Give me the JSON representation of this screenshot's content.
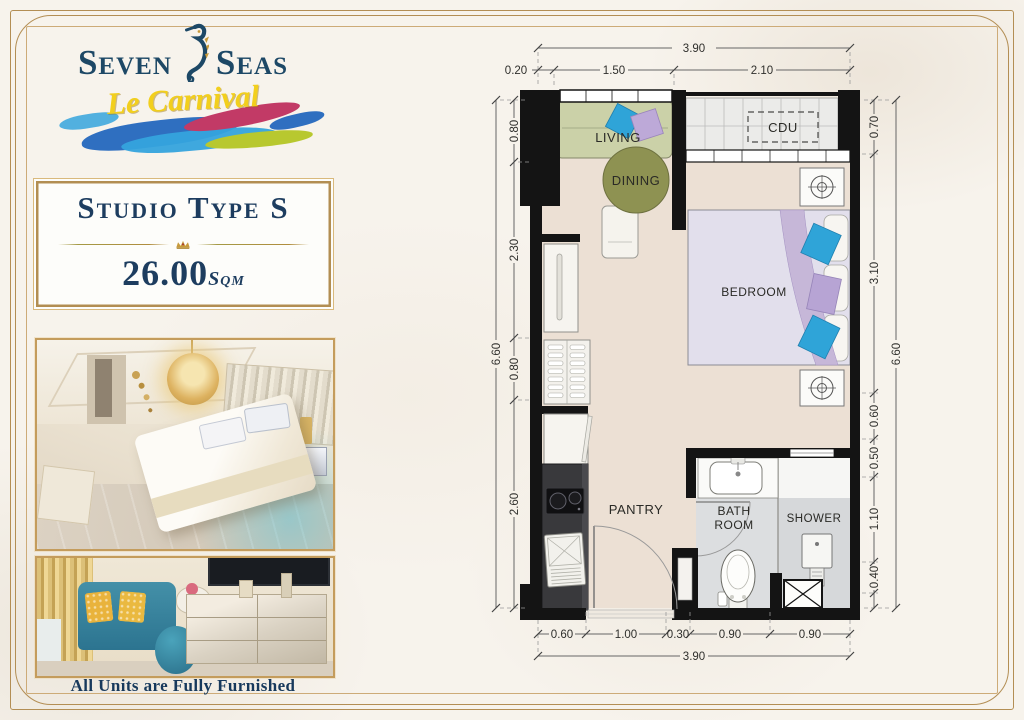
{
  "brand": {
    "name_first": "Seven",
    "name_second": "Seas",
    "tagline": "Le Carnival"
  },
  "unit_card": {
    "title": "Studio Type S",
    "area": "26.00",
    "area_unit": "Sqm"
  },
  "footer_caption": "All Units are Fully Furnished",
  "floor_plan": {
    "rooms": {
      "living": "LIVING",
      "dining": "DINING",
      "cdu": "CDU",
      "bedroom": "BEDROOM",
      "pantry": "PANTRY",
      "bath_line1": "BATH",
      "bath_line2": "ROOM",
      "shower": "SHOWER"
    },
    "dimensions": {
      "top": {
        "overall": "3.90",
        "segments": [
          "0.20",
          "1.50",
          "2.10"
        ]
      },
      "bottom": {
        "overall": "3.90",
        "segments": [
          "0.60",
          "1.00",
          "0.30",
          "0.90",
          "0.90"
        ]
      },
      "left": {
        "overall": "6.60",
        "segments": [
          "0.80",
          "2.30",
          "0.80",
          "2.60"
        ]
      },
      "right": {
        "overall": "6.60",
        "segments": [
          "0.70",
          "3.10",
          "0.60",
          "0.50",
          "1.10",
          "0.40"
        ]
      }
    }
  },
  "colors": {
    "frame_gold": "#b28e52",
    "brand_navy": "#1d4866",
    "tagline_yellow": "#f2cf1d",
    "wall_black": "#141414",
    "floor_beige": "#ece0d4",
    "sofa_green": "#cbd1a8",
    "dining_olive": "#8e9252",
    "pillow_blue": "#2fa4d8",
    "pillow_purple": "#b7a4d4"
  }
}
